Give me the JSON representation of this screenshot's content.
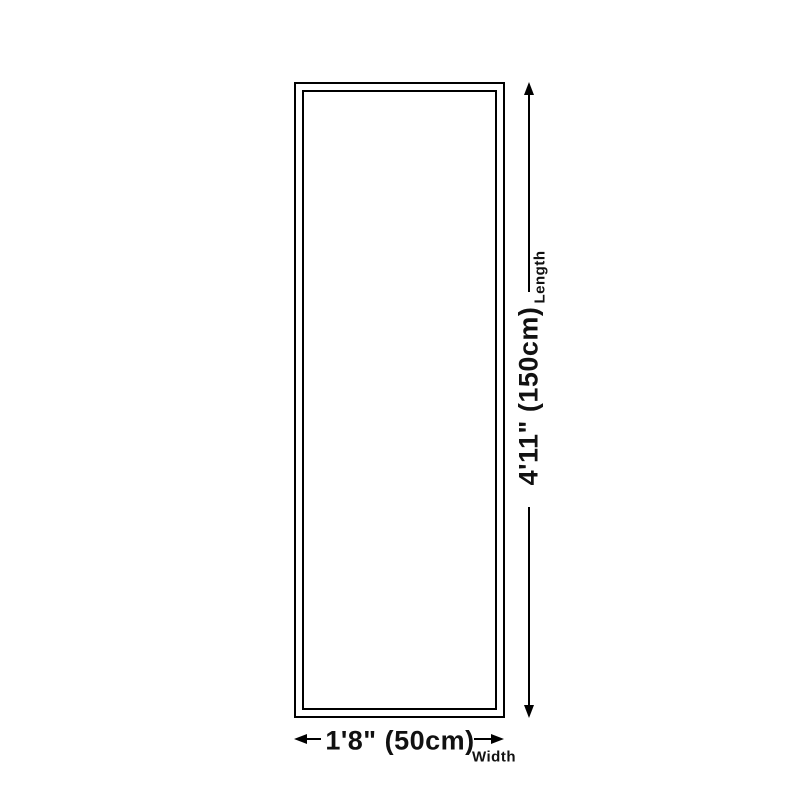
{
  "diagram": {
    "length": {
      "value": "4'11\" (150cm)",
      "label": "Length"
    },
    "width": {
      "value": "1'8\" (50cm)",
      "label": "Width"
    },
    "colors": {
      "line": "#000000",
      "text": "#111111",
      "background": "#ffffff"
    }
  }
}
